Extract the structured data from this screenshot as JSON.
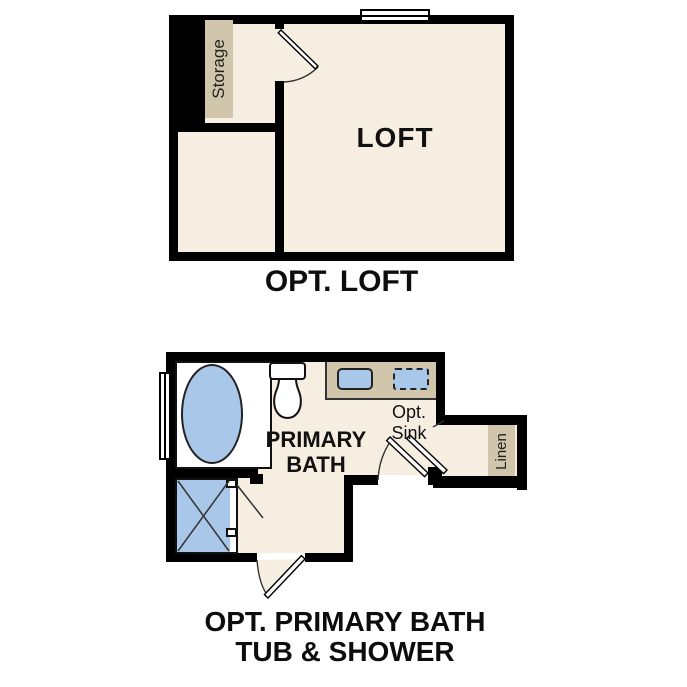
{
  "colors": {
    "floor": "#f6eee1",
    "fixture_tan": "#d1c5ab",
    "fixture_blue": "#a9c8e9",
    "wall": "#000000",
    "text": "#111111"
  },
  "loft": {
    "caption": "OPT. LOFT",
    "room_label": "LOFT",
    "storage_label": "Storage"
  },
  "bath": {
    "caption_line1": "OPT. PRIMARY BATH",
    "caption_line2": "TUB & SHOWER",
    "room_line1": "PRIMARY",
    "room_line2": "BATH",
    "opt_sink_line1": "Opt.",
    "opt_sink_line2": "Sink",
    "linen_label": "Linen"
  }
}
